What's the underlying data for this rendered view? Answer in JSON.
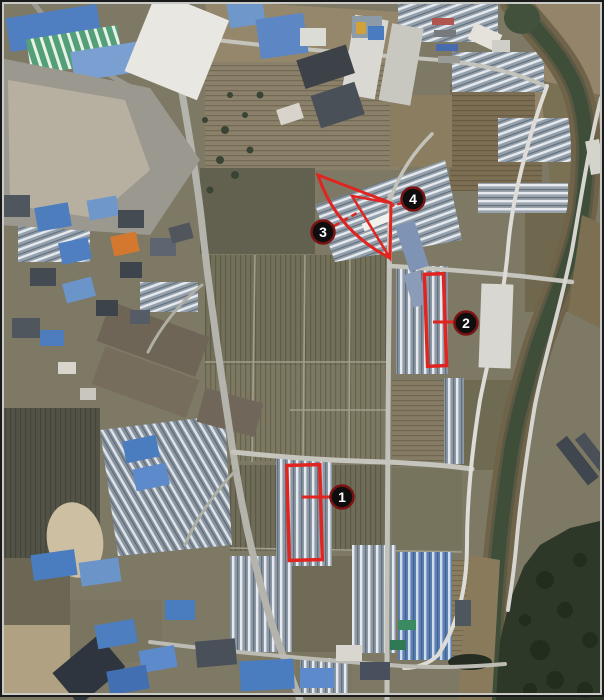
{
  "image_type": "aerial-satellite-photo",
  "annotations": {
    "markers": [
      {
        "label": "1"
      },
      {
        "label": "2"
      },
      {
        "label": "3"
      },
      {
        "label": "4"
      }
    ],
    "shapes": [
      "highlight-rectangle-1",
      "highlight-rectangle-2",
      "highlight-triangle-outer",
      "highlight-triangle-inner"
    ]
  },
  "colors": {
    "annotation-red": "#e02520",
    "marker-ring": "#7a1412",
    "marker-fill": "#0e0e0e",
    "marker-text": "#ffffff",
    "frame": "#1a1a1a",
    "river-water": "#3e4e39",
    "field-olive": "#7d7964",
    "greenhouse-gray": "#8d99a6",
    "roof-blue": "#4d7dbd"
  }
}
